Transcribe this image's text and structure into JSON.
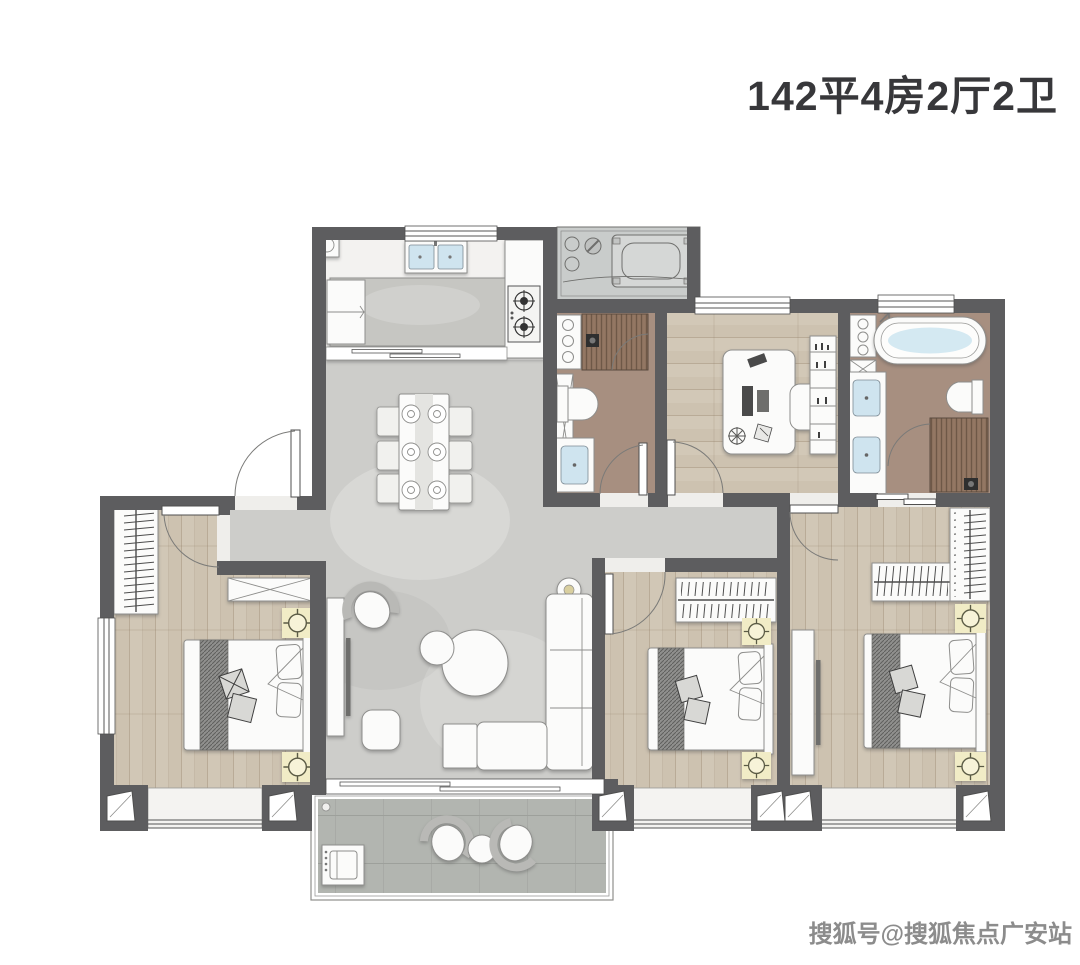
{
  "title": {
    "text": "142平4房2厅2卫"
  },
  "unit": {
    "area_sqm": "142",
    "bedrooms": "4",
    "halls": "2",
    "bathrooms": "2"
  },
  "watermark": {
    "text": "搜狐号@搜狐焦点广安站"
  },
  "colors": {
    "bg": "#ffffff",
    "wall": "#5d5d5f",
    "marble": "#cdcdca",
    "wood": "#cdc2b0",
    "woodLine": "#b9ab97",
    "bath": "#a78f80",
    "shower": "#937763",
    "showerStripe": "#6e5847",
    "balcony": "#b2b5b0",
    "platform": "#c9cccb",
    "sill": "#f4f3f1",
    "lampSquare": "#f1ecc6",
    "basinBlue": "#cfe4ef",
    "furniture": "#fbfbfa",
    "furnitureStroke": "#8e8e8c",
    "title": "#37373a",
    "watermark": "#8c8c8c"
  },
  "rooms": [
    {
      "id": "kitchen",
      "features": [
        "double-sink",
        "window",
        "fridge",
        "island-counter",
        "gas-stove",
        "sliding-door"
      ]
    },
    {
      "id": "equipment-platform",
      "features": [
        "ac-outdoor-unit",
        "pipes"
      ]
    },
    {
      "id": "bathroom-common",
      "features": [
        "shower",
        "toilet",
        "vanity-basin",
        "storage-cabinet"
      ]
    },
    {
      "id": "study-bedroom",
      "features": [
        "desk",
        "office-chair",
        "bookshelf",
        "window"
      ]
    },
    {
      "id": "master-bathroom",
      "features": [
        "bathtub",
        "double-vanity",
        "toilet",
        "shower",
        "window",
        "sliding-door"
      ]
    },
    {
      "id": "foyer",
      "features": [
        "entry-door",
        "shoe-cabinet"
      ]
    },
    {
      "id": "dining-area",
      "features": [
        "dining-table",
        "six-chairs",
        "place-settings"
      ]
    },
    {
      "id": "living-room",
      "features": [
        "tv-cabinet",
        "tv",
        "armchair",
        "coffee-tables",
        "l-sofa",
        "side-table",
        "pouf",
        "floor-lamp",
        "balcony-sliding-door"
      ]
    },
    {
      "id": "bedroom-1",
      "features": [
        "wardrobe",
        "storage-cabinet",
        "double-bed",
        "nightstands",
        "lamps",
        "window",
        "bay-window"
      ]
    },
    {
      "id": "bedroom-2",
      "features": [
        "wardrobe",
        "double-bed",
        "nightstands",
        "lamps",
        "bay-window"
      ]
    },
    {
      "id": "master-bedroom",
      "features": [
        "l-wardrobe",
        "double-bed",
        "nightstands",
        "lamps",
        "tv-cabinet",
        "bay-window"
      ]
    },
    {
      "id": "balcony",
      "features": [
        "washing-machine",
        "lounge-chairs",
        "round-table"
      ]
    }
  ]
}
